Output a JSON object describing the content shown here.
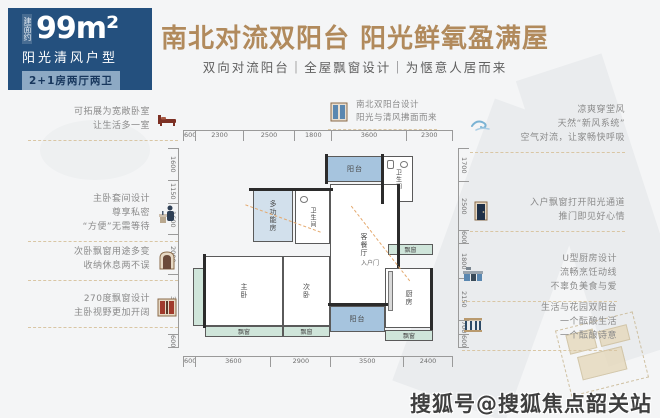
{
  "badge": {
    "area_prefix": "建面约",
    "area": "99m²",
    "type_name": "阳光清风户型",
    "layout": "2+1房两厅两卫"
  },
  "header": {
    "title": "南北对流双阳台 阳光鲜氧盈满屋",
    "subtitle": "双向对流阳台｜全屋飘窗设计｜为惬意人居而来"
  },
  "top_callout": {
    "icon": "double-balcony-icon",
    "lines": [
      "南北双阳台设计",
      "阳光与清风拂面而来"
    ]
  },
  "left_callouts": [
    {
      "icon": "bed-icon",
      "lines": [
        "可拓展为宽敞卧室",
        "让生活多一室"
      ]
    },
    {
      "icon": "washbasin-icon",
      "lines": [
        "主卧套间设计",
        "尊享私密",
        "“方便”无需等待"
      ]
    },
    {
      "icon": "bay-window-icon",
      "lines": [
        "次卧飘窗用途多变",
        "收纳休息两不误"
      ]
    },
    {
      "icon": "corner-window-icon",
      "lines": [
        "270度飘窗设计",
        "主卧视野更加开阔"
      ]
    }
  ],
  "right_callouts": [
    {
      "icon": "wind-icon",
      "lines": [
        "凉爽穿堂风",
        "天然“新风系统”",
        "空气对流，让家畅快呼吸"
      ]
    },
    {
      "icon": "door-icon",
      "lines": [
        "入户飘窗打开阳光通道",
        "推门即见好心情"
      ]
    },
    {
      "icon": "kitchen-icon",
      "lines": [
        "U型厨房设计",
        "流畅烹饪动线",
        "不辜负美食与爱"
      ]
    },
    {
      "icon": "balcony-icon",
      "lines": [
        "生活与花园双阳台",
        "一个酝酿生活",
        "一个酝酿诗意"
      ]
    }
  ],
  "floorplan": {
    "rooms": [
      {
        "name": "north-balcony",
        "label": "阳台"
      },
      {
        "name": "bath-north",
        "label": "卫生间"
      },
      {
        "name": "multi-room",
        "label": "多功能房"
      },
      {
        "name": "bath-center",
        "label": "卫生间"
      },
      {
        "name": "living-dining",
        "label": "客餐厅"
      },
      {
        "name": "master-bedroom",
        "label": "主卧"
      },
      {
        "name": "second-bedroom",
        "label": "次卧"
      },
      {
        "name": "kitchen",
        "label": "厨房"
      },
      {
        "name": "south-balcony",
        "label": "阳台"
      },
      {
        "name": "bay-master-bottom",
        "label": "飘窗"
      },
      {
        "name": "bay-second-bottom",
        "label": "飘窗"
      },
      {
        "name": "bay-kitchen-right",
        "label": "飘窗"
      },
      {
        "name": "bay-kitchen-bottom",
        "label": "飘窗"
      }
    ],
    "entry_label": "入户门",
    "dims_top": [
      "600",
      "2300",
      "2500",
      "1800",
      "3600",
      "2300"
    ],
    "dims_bottom": [
      "600",
      "3600",
      "2900",
      "3500",
      "2400"
    ],
    "dims_left": [
      "1600",
      "1150",
      "1600",
      "2000",
      "3000",
      "600"
    ],
    "dims_right": [
      "1700",
      "2500",
      "600",
      "1800",
      "2150",
      "700",
      "600"
    ]
  },
  "watermark": "搜狐号@搜狐焦点韶关站",
  "colors": {
    "accent_blue": "#24507e",
    "title_tan": "#b18a5c",
    "balcony_blue": "#a6c4de",
    "bay_mint": "#cfe5da",
    "room_blue": "#d2e0ec",
    "wall": "#2b2b2b"
  }
}
